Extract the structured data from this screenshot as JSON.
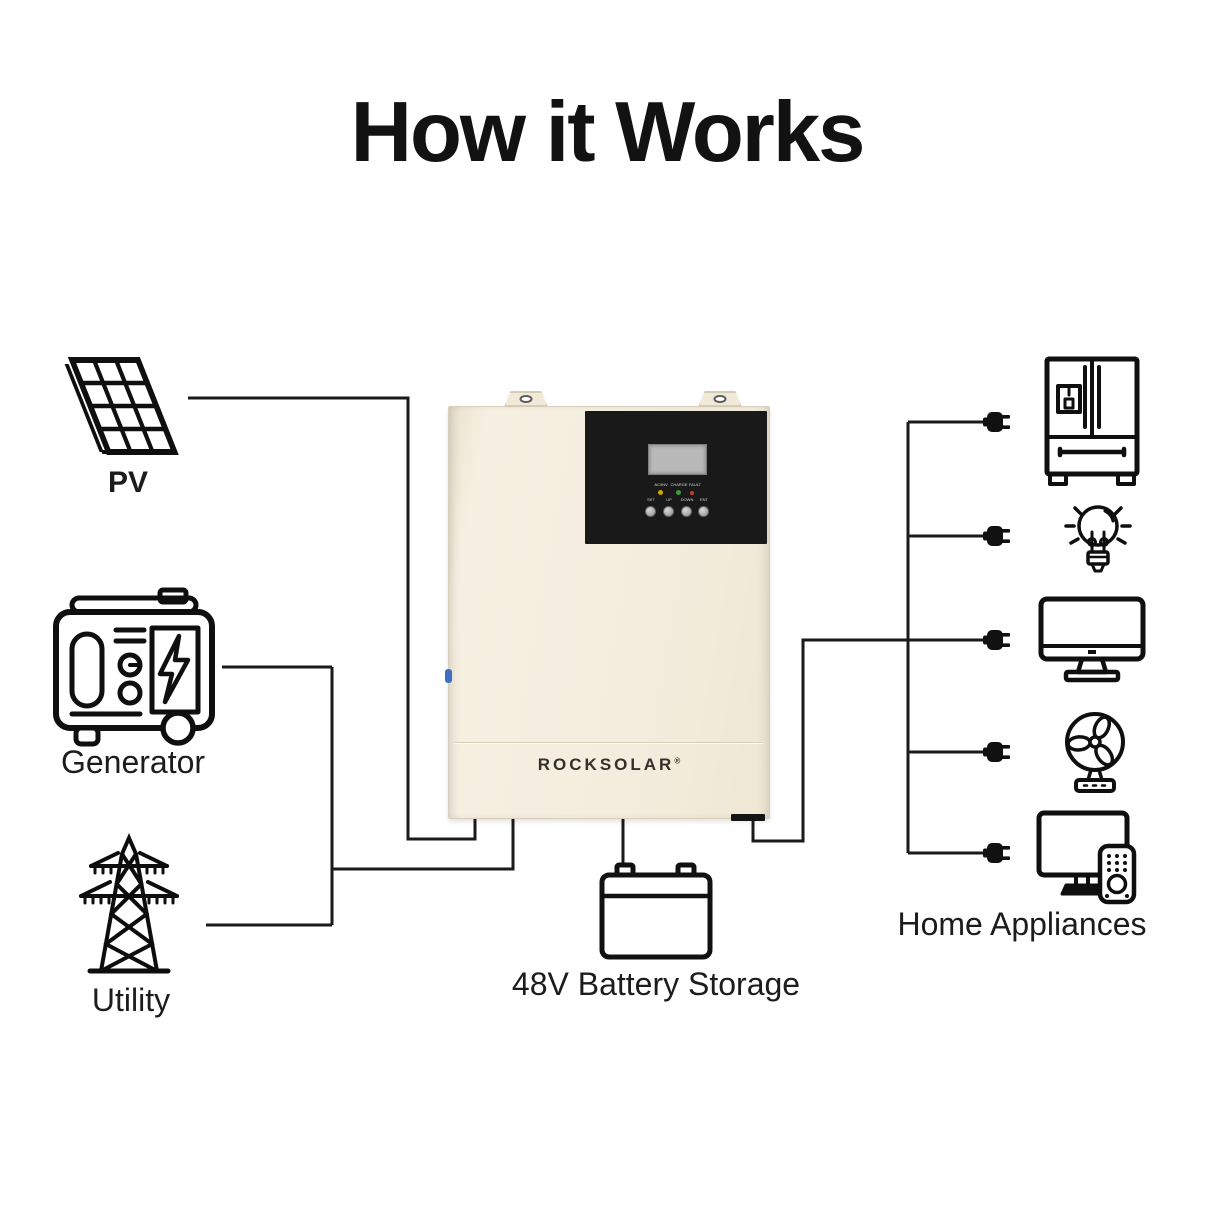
{
  "title": "How it Works",
  "sources": {
    "pv": {
      "label": "PV",
      "icon": "solar-panel-icon"
    },
    "generator": {
      "label": "Generator",
      "icon": "generator-icon"
    },
    "utility": {
      "label": "Utility",
      "icon": "utility-tower-icon"
    }
  },
  "inverter": {
    "brand": "ROCKSOLAR",
    "trademark": "®",
    "display": {
      "leds": [
        {
          "label": "AC/INV",
          "color": "#d6a500"
        },
        {
          "label": "CHARGE",
          "color": "#35a03a"
        },
        {
          "label": "FAULT",
          "color": "#c43a2a"
        }
      ],
      "buttons": [
        {
          "label": "SET"
        },
        {
          "label": "UP"
        },
        {
          "label": "DOWN"
        },
        {
          "label": "ENT"
        }
      ]
    }
  },
  "battery": {
    "label": "48V Battery Storage",
    "icon": "battery-icon"
  },
  "appliances": {
    "label": "Home Appliances",
    "items": [
      {
        "name": "refrigerator-icon"
      },
      {
        "name": "light-bulb-icon"
      },
      {
        "name": "monitor-icon"
      },
      {
        "name": "fan-icon"
      },
      {
        "name": "tv-remote-icon"
      }
    ]
  },
  "colors": {
    "background": "#ffffff",
    "line": "#1a1a1a",
    "inverter_body": "#f4edde",
    "inverter_panel": "#191919",
    "lcd": "#b9b9b9",
    "accent_blue": "#3f6fbe"
  }
}
